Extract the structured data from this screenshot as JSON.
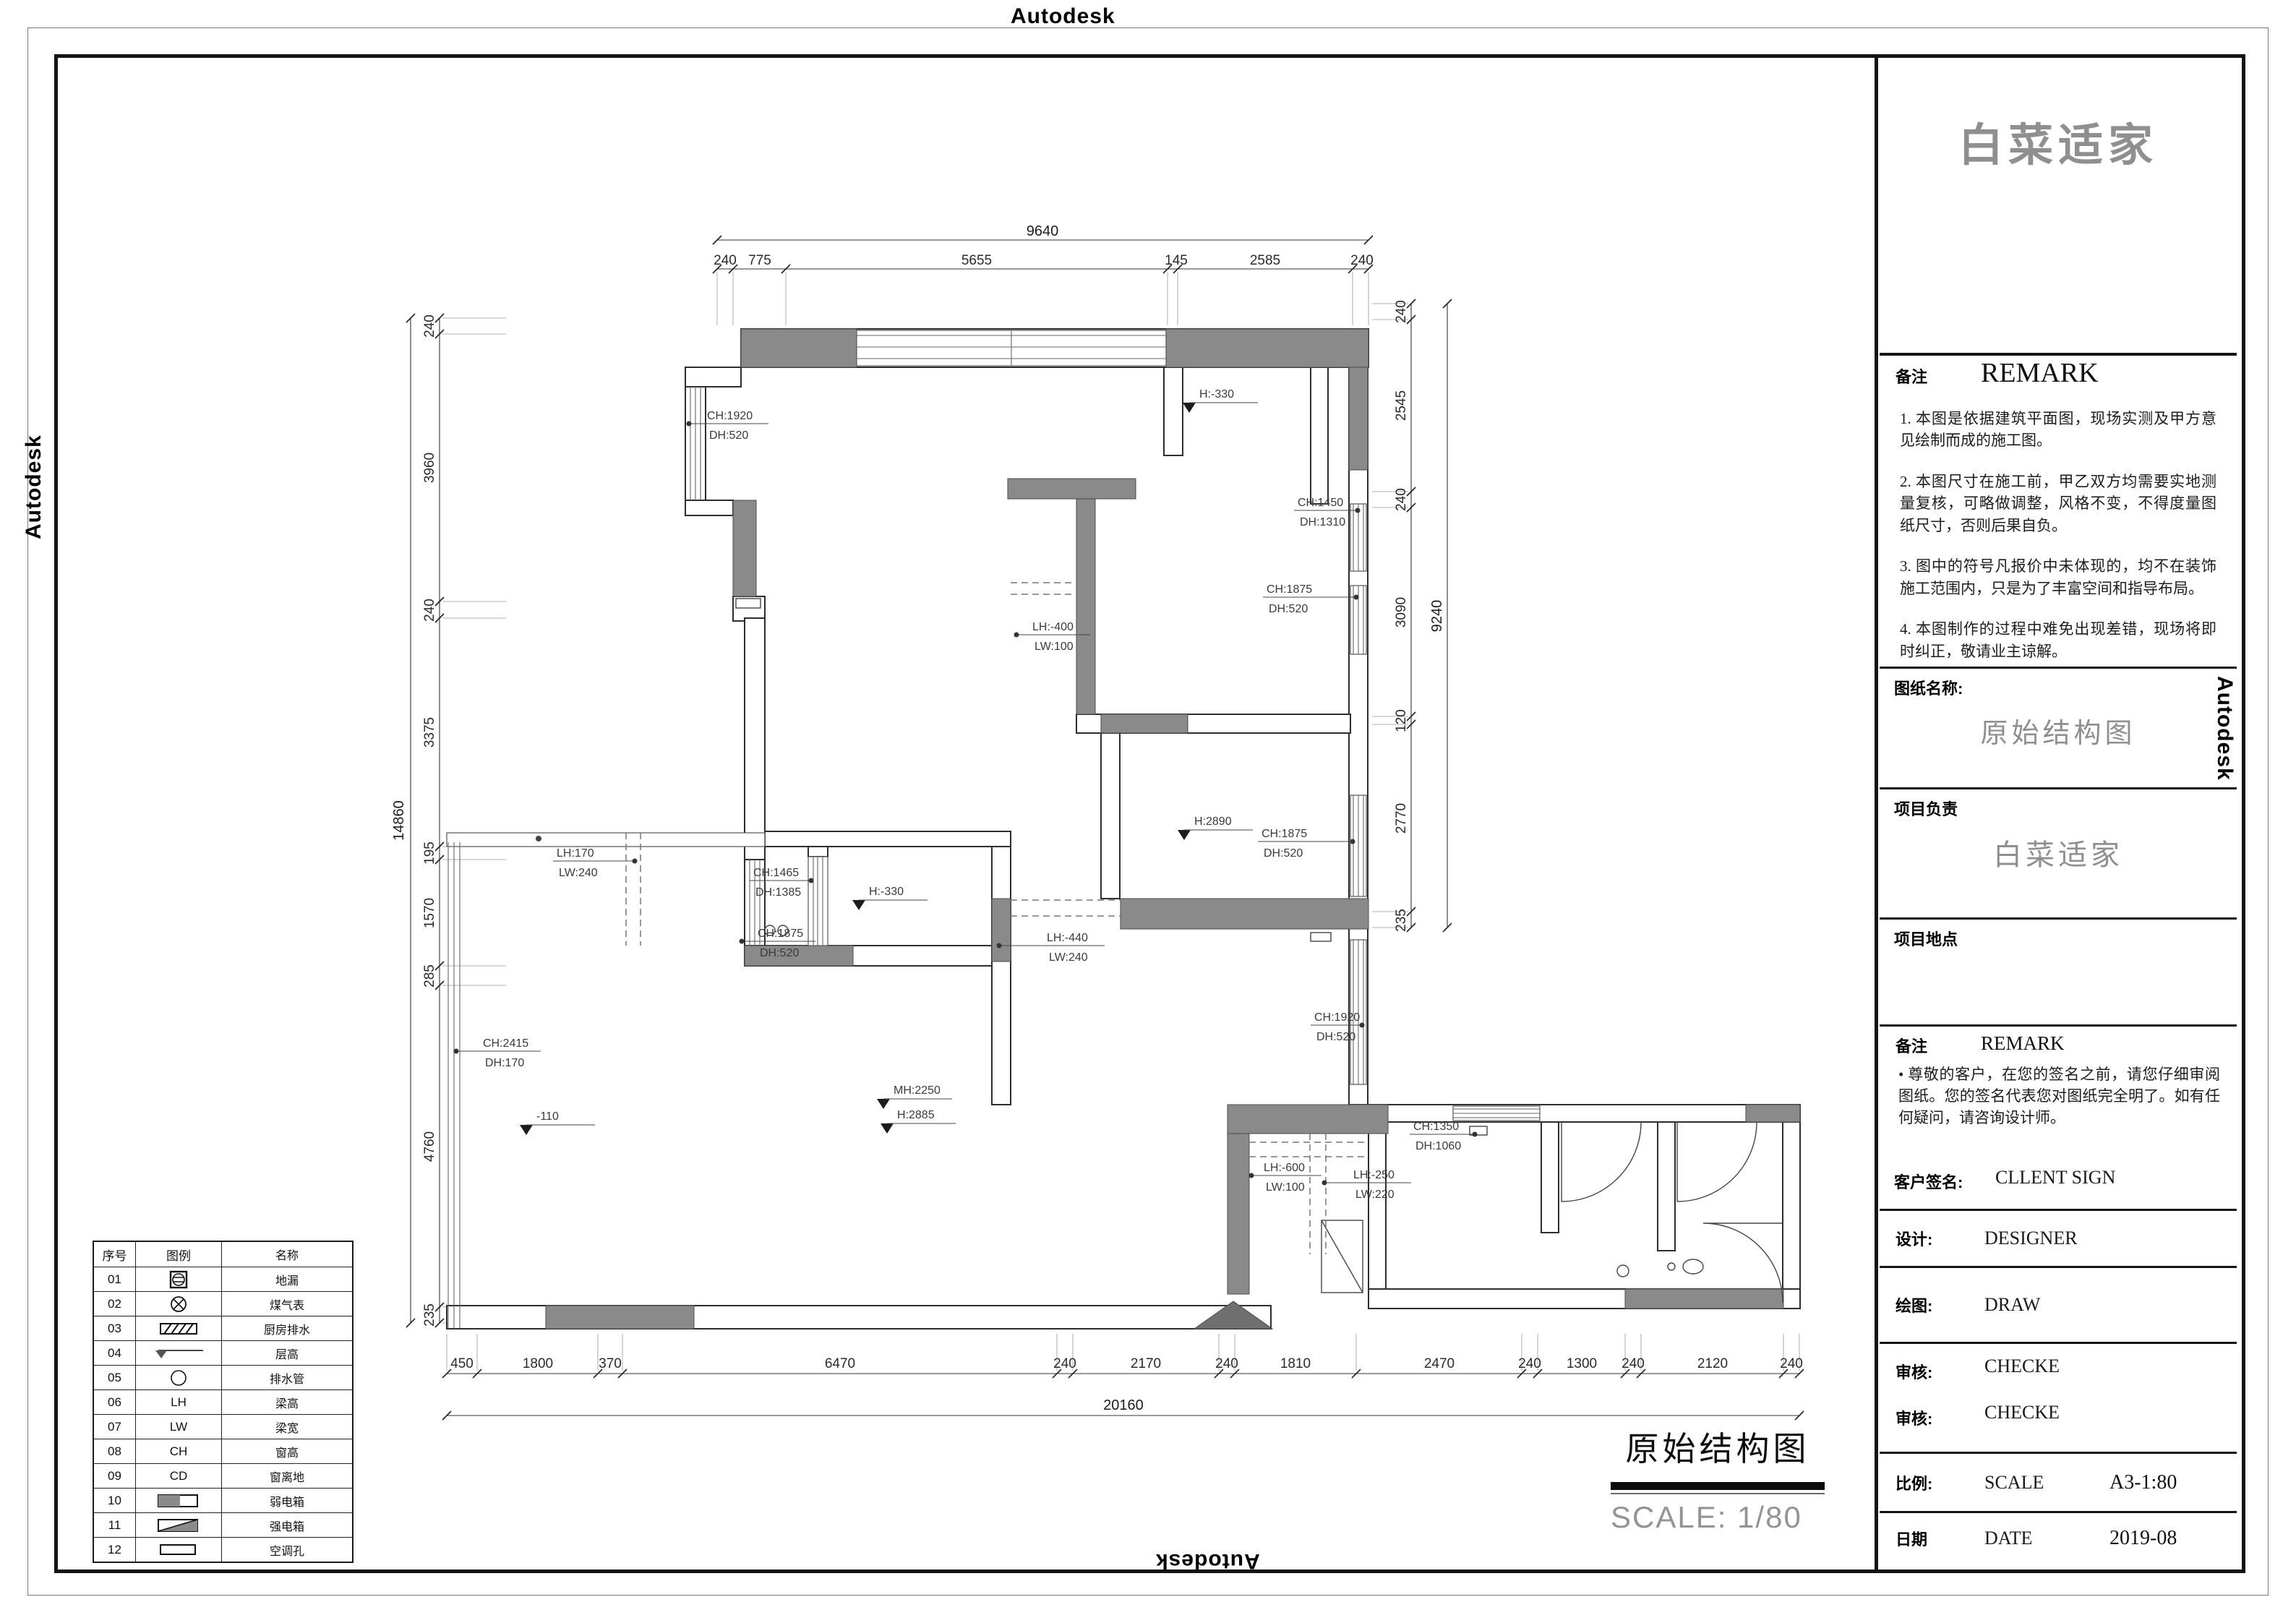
{
  "watermark": {
    "text": "Autodesk"
  },
  "title_block": {
    "logo": "白菜适家",
    "remark_top": {
      "label_cn": "备注",
      "label_en": "REMARK",
      "notes": [
        "1. 本图是依据建筑平面图，现场实测及甲方意见绘制而成的施工图。",
        "2. 本图尺寸在施工前，甲乙双方均需要实地测量复核，可略做调整，风格不变，不得度量图纸尺寸，否则后果自负。",
        "3. 图中的符号凡报价中未体现的，均不在装饰施工范围内，只是为了丰富空间和指导布局。",
        "4. 本图制作的过程中难免出现差错，现场将即时纠正，敬请业主谅解。"
      ]
    },
    "sheet_name": {
      "label": "图纸名称:",
      "value": "原始结构图"
    },
    "project_lead": {
      "label": "项目负责",
      "value": "白菜适家"
    },
    "project_site": {
      "label": "项目地点",
      "value": ""
    },
    "remark_bottom": {
      "label_cn": "备注",
      "label_en": "REMARK",
      "bullet": "• 尊敬的客户，在您的签名之前，请您仔细审阅图纸。您的签名代表您对图纸完全明了。如有任何疑问，请咨询设计师。",
      "sign_label": "客户签名:",
      "sign_value": "CLLENT SIGN"
    },
    "design": {
      "label": "设计:",
      "value": "DESIGNER"
    },
    "draw": {
      "label": "绘图:",
      "value": "DRAW"
    },
    "check1": {
      "label": "审核:",
      "value": "CHECKE"
    },
    "check2": {
      "label": "审核:",
      "value": "CHECKE"
    },
    "scale": {
      "label": "比例:",
      "en": "SCALE",
      "value": "A3-1:80"
    },
    "date": {
      "label": "日期",
      "en": "DATE",
      "value": "2019-08"
    }
  },
  "plan": {
    "title": "原始结构图",
    "scale_text": "SCALE: 1/80",
    "dims": {
      "top_total": "9640",
      "top": [
        "240",
        "775",
        "5655",
        "145",
        "2585",
        "240"
      ],
      "left_total": "14860",
      "left": [
        "240",
        "3960",
        "240",
        "3375",
        "195",
        "1570",
        "285",
        "4760",
        "235"
      ],
      "right_total": "9240",
      "right": [
        "240",
        "2545",
        "240",
        "3090",
        "120",
        "2770",
        "235"
      ],
      "bottom_total": "20160",
      "bottom": [
        "450",
        "1800",
        "370",
        "6470",
        "240",
        "2170",
        "240",
        "1810",
        "2470",
        "240",
        "1300",
        "240",
        "2120",
        "240"
      ]
    },
    "labels": [
      {
        "l1": "CH:1920",
        "l2": "DH:520"
      },
      {
        "l1": "CH:1450",
        "l2": "DH:1310"
      },
      {
        "l1": "CH:1875",
        "l2": "DH:520"
      },
      {
        "l1": "LH:-400",
        "l2": "LW:100"
      },
      {
        "l1": "LH:170",
        "l2": "LW:240"
      },
      {
        "l1": "CH:1465",
        "l2": "DH:1385"
      },
      {
        "l1": "LH:-440",
        "l2": "LW:240"
      },
      {
        "l1": "CH:1875",
        "l2": "DH:520"
      },
      {
        "l1": "CH:1875",
        "l2": "DH:520"
      },
      {
        "l1": "CH:1920",
        "l2": "DH:520"
      },
      {
        "l1": "CH:2415",
        "l2": "DH:170"
      },
      {
        "l1": "CH:1350",
        "l2": "DH:1060"
      },
      {
        "l1": "LH:-600",
        "l2": "LW:100"
      },
      {
        "l1": "LH:-250",
        "l2": "LW:220"
      }
    ],
    "levels": [
      {
        "text": "H:-330"
      },
      {
        "text": "H:-330"
      },
      {
        "text": "H:2890"
      },
      {
        "text": "MH:2250"
      },
      {
        "text": "H:2885"
      },
      {
        "text": "-110"
      }
    ]
  },
  "legend": {
    "headers": [
      "序号",
      "图例",
      "名称"
    ],
    "rows": [
      {
        "no": "01",
        "symbol": "floor-drain",
        "sym_text": "",
        "name": "地漏"
      },
      {
        "no": "02",
        "symbol": "gas-meter",
        "sym_text": "",
        "name": "煤气表"
      },
      {
        "no": "03",
        "symbol": "kitchen-drain",
        "sym_text": "",
        "name": "厨房排水"
      },
      {
        "no": "04",
        "symbol": "level-mark",
        "sym_text": "",
        "name": "层高"
      },
      {
        "no": "05",
        "symbol": "drain-pipe",
        "sym_text": "",
        "name": "排水管"
      },
      {
        "no": "06",
        "symbol": "text",
        "sym_text": "LH",
        "name": "梁高"
      },
      {
        "no": "07",
        "symbol": "text",
        "sym_text": "LW",
        "name": "梁宽"
      },
      {
        "no": "08",
        "symbol": "text",
        "sym_text": "CH",
        "name": "窗高"
      },
      {
        "no": "09",
        "symbol": "text",
        "sym_text": "CD",
        "name": "窗离地"
      },
      {
        "no": "10",
        "symbol": "weak-current-box",
        "sym_text": "",
        "name": "弱电箱"
      },
      {
        "no": "11",
        "symbol": "strong-current-box",
        "sym_text": "",
        "name": "强电箱"
      },
      {
        "no": "12",
        "symbol": "ac-hole",
        "sym_text": "",
        "name": "空调孔"
      }
    ]
  }
}
